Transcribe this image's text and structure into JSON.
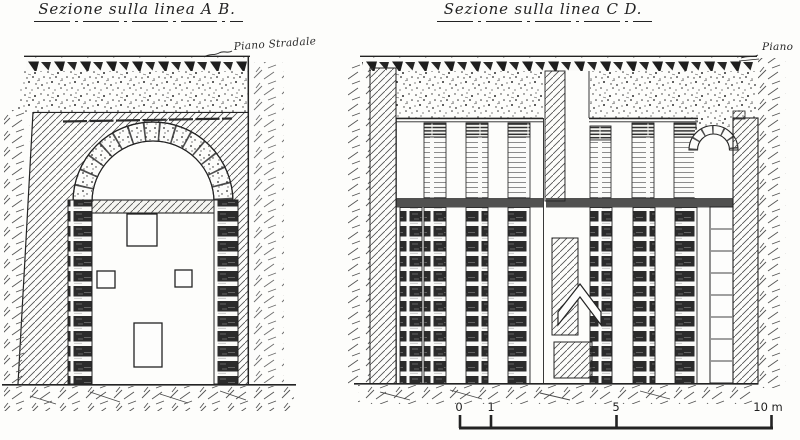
{
  "colors": {
    "paper": "#fdfdfb",
    "ink": "#232323"
  },
  "titles": {
    "left": "Sezione sulla linea A B.",
    "right": "Sezione sulla linea C D."
  },
  "annotations": {
    "street_level_left": "Piano Stradale",
    "street_level_right": "Piano"
  },
  "scale_bar": {
    "unit": "m",
    "tick_labels": [
      "0",
      "1",
      "5",
      "10 m"
    ]
  }
}
